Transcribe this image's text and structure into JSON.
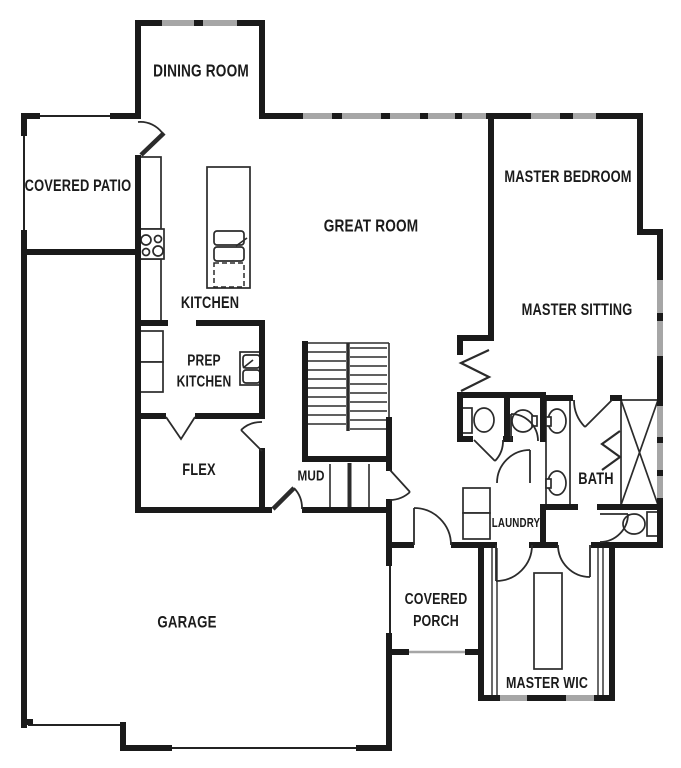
{
  "plan": {
    "type": "single-story floor plan",
    "background": "#ffffff",
    "wall_color": "#1a1a1a",
    "window_color": "#a6a6a6",
    "rooms": {
      "dining": {
        "label": "DINING ROOM"
      },
      "covered_patio": {
        "label": "COVERED PATIO"
      },
      "kitchen": {
        "label": "KITCHEN"
      },
      "great_room": {
        "label": "GREAT ROOM"
      },
      "master_bedroom": {
        "label": "MASTER BEDROOM"
      },
      "master_sitting": {
        "label": "MASTER SITTING"
      },
      "prep_kitchen": {
        "line1": "PREP",
        "line2": "KITCHEN"
      },
      "flex": {
        "label": "FLEX"
      },
      "mud": {
        "label": "MUD"
      },
      "bath": {
        "label": "BATH"
      },
      "laundry": {
        "label": "LAUNDRY"
      },
      "garage": {
        "label": "GARAGE"
      },
      "covered_porch": {
        "line1": "COVERED",
        "line2": "PORCH"
      },
      "master_wic": {
        "label": "MASTER WIC"
      }
    },
    "fixtures": [
      "cooktop",
      "kitchen-counter",
      "kitchen-island",
      "island-sink",
      "dishwasher",
      "prep-sink",
      "prep-fridge",
      "staircase",
      "mud-lockers",
      "washer-dryer",
      "powder-toilet",
      "powder-sink",
      "double-vanity-sinks",
      "shower",
      "toilet",
      "wic-island",
      "wic-shelving",
      "windows",
      "door-swings"
    ]
  }
}
